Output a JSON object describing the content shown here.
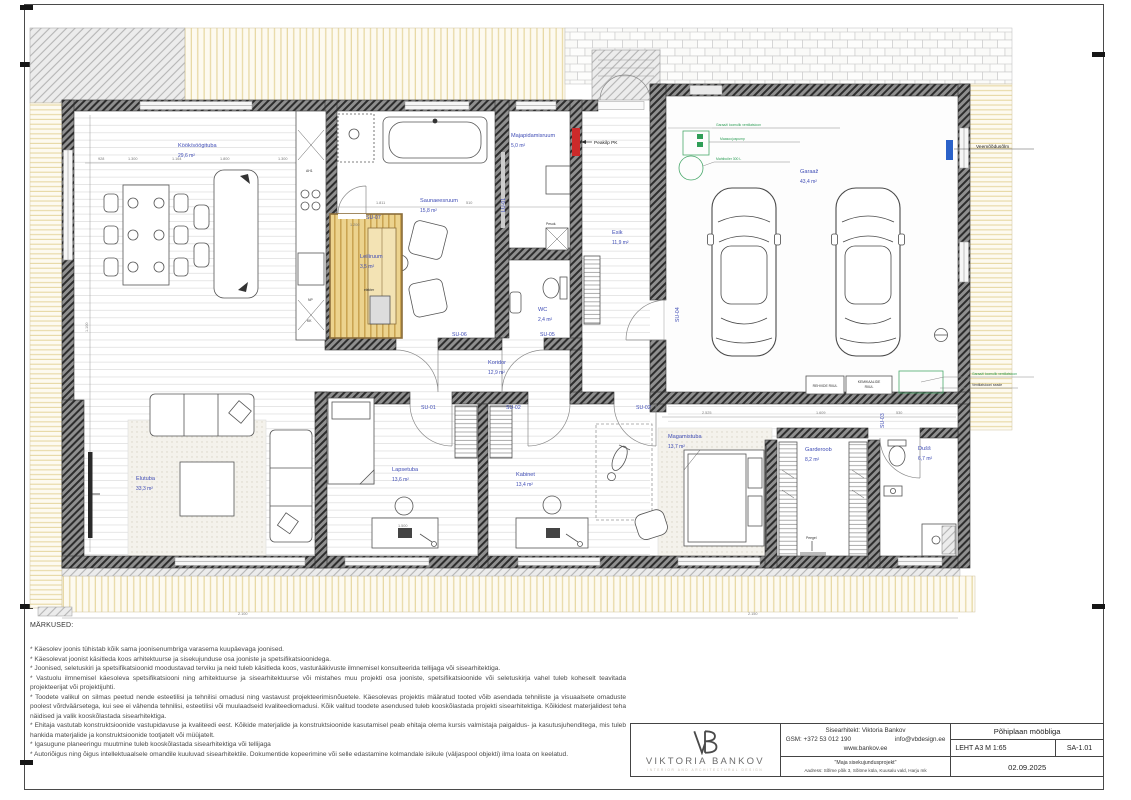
{
  "notes": {
    "title": "MÄRKUSED:",
    "items": [
      "* Käesolev joonis tühistab kõik sama joonisenumbriga varasema kuupäevaga joonised.",
      "* Käesolevat joonist käsitleda koos arhitektuurse ja sisekujunduse osa jooniste ja spetsifikatsioonidega.",
      "* Joonised, seletuskiri ja spetsifikatsioonid moodustavad terviku ja neid tuleb käsitleda koos, vasturääkivuste ilmnemisel konsulteerida tellijaga või sisearhitektiga.",
      "* Vastuolu ilmnemisel käesoleva spetsifikatsiooni ning arhitektuurse ja sisearhitektuurse või mistahes muu projekti osa jooniste, spetsifikatsioonide või seletuskirja vahel tuleb koheselt teavitada projekteerijat või projektijuhti.",
      "* Toodete valikul on silmas peetud nende esteetilisi ja tehnilisi omadusi ning vastavust projekteerimisnõuetele. Käesolevas projektis määratud tooted võib asendada tehniliste ja visuaalsete omaduste poolest võrdväärsetega, kui see ei vähenda tehnilisi, esteetilisi või muulaadseid kvaliteediomadusi. Kõik valitud toodete asendused tuleb kooskõlastada projekti sisearhitektiga. Kõikidest materjalidest teha näidised ja valik kooskõlastada sisearhitektiga.",
      "* Ehitaja vastutab konstruktsioonide vastupidavuse ja kvaliteedi eest. Kõikide materjalide ja konstruktsioonide kasutamisel peab ehitaja olema kursis valmistaja paigaldus- ja kasutusjuhenditega, mis tuleb hankida materjalide ja konstruktsioonide tootjatelt või müüjatelt.",
      "* Igasugune planeeringu muutmine tuleb kooskõlastada sisearhitektiga või tellijaga",
      "* Autoriõigus ning õigus intellektuaalsele omandile kuuluvad sisearhitektile. Dokumentide kopeerimine või selle edastamine kolmandale isikule (väljaspool objekti) ilma loata on keelatud."
    ]
  },
  "title_block": {
    "logo_name": "VIKTORIA BANKOV",
    "logo_sub": "INTERIOR AND ARCHITECTURAL DESIGN",
    "architect": "Sisearhitekt: Viktoria Bankov",
    "gsm": "GSM: +372  53 012 190",
    "email": "info@vbdesign.ee",
    "website": "www.bankov.ee",
    "project": "\"Maja sisekujundusprojekt\"",
    "address": "Aadress: Sõlme põik 3, Sõitme küla, Kuusalu vald, Harju mk",
    "sheet_title": "Põhiplaan mööbliga",
    "sheet_format_scale": "LEHT A3  M 1:65",
    "sheet_no": "SA-1.01",
    "date": "02.09.2025"
  },
  "plan": {
    "rooms": [
      {
        "name": "Köök/söögituba",
        "area": "29,6 m²",
        "x": 178,
        "y": 147
      },
      {
        "name": "Saunaeesruum",
        "area": "15,8 m²",
        "x": 420,
        "y": 202
      },
      {
        "name": "Leiliruum",
        "area": "3,5 m²",
        "x": 360,
        "y": 258
      },
      {
        "name": "Majapidamisruum",
        "area": "5,0 m²",
        "x": 511,
        "y": 137
      },
      {
        "name": "WC",
        "area": "2,4 m²",
        "x": 538,
        "y": 311
      },
      {
        "name": "Esik",
        "area": "11,9 m²",
        "x": 612,
        "y": 234
      },
      {
        "name": "Garaaž",
        "area": "43,4 m²",
        "x": 800,
        "y": 173
      },
      {
        "name": "Koridor",
        "area": "12,9 m²",
        "x": 488,
        "y": 364
      },
      {
        "name": "Elutuba",
        "area": "33,3 m²",
        "x": 136,
        "y": 480
      },
      {
        "name": "Lapsetuba",
        "area": "13,6 m²",
        "x": 392,
        "y": 471
      },
      {
        "name": "Kabinet",
        "area": "13,4 m²",
        "x": 516,
        "y": 476
      },
      {
        "name": "Magamistuba",
        "area": "13,7 m²",
        "x": 668,
        "y": 438
      },
      {
        "name": "Garderoob",
        "area": "8,2 m²",
        "x": 805,
        "y": 451
      },
      {
        "name": "Dušš",
        "area": "6,7 m²",
        "x": 918,
        "y": 450
      }
    ],
    "doors": [
      {
        "text": "SU-07",
        "x": 366,
        "y": 219
      },
      {
        "text": "SU-06",
        "x": 452,
        "y": 336
      },
      {
        "text": "SU-05",
        "x": 540,
        "y": 336
      },
      {
        "text": "LU-01",
        "x": 505,
        "y": 212,
        "rot": -90
      },
      {
        "text": "SU-01",
        "x": 421,
        "y": 409
      },
      {
        "text": "SU-02",
        "x": 506,
        "y": 409
      },
      {
        "text": "SU-02",
        "x": 636,
        "y": 409
      },
      {
        "text": "SU-03",
        "x": 884,
        "y": 428,
        "rot": -90
      },
      {
        "text": "SU-04",
        "x": 679,
        "y": 322,
        "rot": -90
      }
    ],
    "annotations": [
      {
        "text": "Peakilp PK",
        "x": 594,
        "y": 144
      },
      {
        "text": "Veemõõdusõlm",
        "x": 976,
        "y": 148
      },
      {
        "text": "Garaaži loomulik ventilatsioon",
        "x": 716,
        "y": 126,
        "kind": "tiny green"
      },
      {
        "text": "Maasoojuspump",
        "x": 720,
        "y": 140,
        "kind": "tiny green"
      },
      {
        "text": "Mahtboiler 300 L",
        "x": 716,
        "y": 160,
        "kind": "tiny green"
      },
      {
        "text": "Garaaži loomulik ventilatsioon",
        "x": 972,
        "y": 375,
        "kind": "tiny green"
      },
      {
        "text": "Ventilatsiooni seade",
        "x": 972,
        "y": 386,
        "kind": "tiny"
      },
      {
        "text": "REHVIDE RIIUL",
        "x": 825,
        "y": 387,
        "kind": "tiny center"
      },
      {
        "text": "KEMIKAALIDE",
        "x": 869,
        "y": 383,
        "kind": "tiny center"
      },
      {
        "text": "RIIUL",
        "x": 869,
        "y": 388,
        "kind": "tiny center"
      },
      {
        "text": "Peegel",
        "x": 806,
        "y": 539,
        "kind": "tiny"
      },
      {
        "text": "elekter",
        "x": 364,
        "y": 291,
        "kind": "tiny"
      },
      {
        "text": "Pesuk.",
        "x": 546,
        "y": 225,
        "kind": "tiny"
      },
      {
        "text": "AH1",
        "x": 306,
        "y": 172,
        "kind": "tiny"
      },
      {
        "text": "NP",
        "x": 308,
        "y": 301,
        "kind": "tiny"
      },
      {
        "text": "KK",
        "x": 307,
        "y": 322,
        "kind": "tiny"
      }
    ],
    "dimensions": [
      {
        "text": "928",
        "x": 98,
        "y": 160
      },
      {
        "text": "1.300",
        "x": 128,
        "y": 160
      },
      {
        "text": "1.164",
        "x": 172,
        "y": 160
      },
      {
        "text": "1.800",
        "x": 220,
        "y": 160
      },
      {
        "text": "1.300",
        "x": 278,
        "y": 160
      },
      {
        "text": "1.811",
        "x": 376,
        "y": 204
      },
      {
        "text": "510",
        "x": 466,
        "y": 204
      },
      {
        "text": "1.200",
        "x": 350,
        "y": 226
      },
      {
        "text": "2.330",
        "x": 660,
        "y": 252,
        "rot": -90
      },
      {
        "text": "1.100",
        "x": 88,
        "y": 332,
        "rot": -90
      },
      {
        "text": "2.525",
        "x": 702,
        "y": 414
      },
      {
        "text": "1.609",
        "x": 816,
        "y": 414
      },
      {
        "text": "530",
        "x": 896,
        "y": 414
      },
      {
        "text": "1.500",
        "x": 398,
        "y": 527
      },
      {
        "text": "2.100",
        "x": 238,
        "y": 615
      },
      {
        "text": "2.150",
        "x": 748,
        "y": 615
      }
    ]
  }
}
